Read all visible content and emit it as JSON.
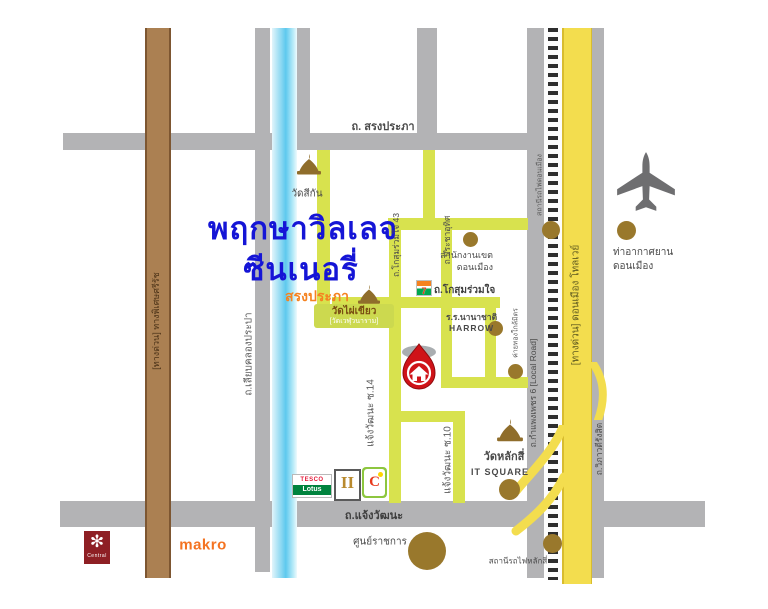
{
  "map": {
    "title_line1": "พฤกษาวิลเลจ",
    "title_line2": "ซีนเนอรี่",
    "title_subtitle": "สรงประภา",
    "roads": {
      "song_prapha": "ถ. สรงประภา",
      "chaengwattana": "ถ.แจ้งวัฒนะ",
      "srirat_expressway": "[ทางด่วน] ทางพิเศษศรีรัช",
      "liap_khlong_prapa": "ถ.เลียบคลองประปา",
      "kosum_ruam_chai_43": "ถ.โกสุมร่วมใจ 43",
      "pracha_uthit": "ถ.ประชาอุทิศ",
      "kosum_ruam_chai": "ถ.โกสุมร่วมใจ",
      "chaengwattana_soi_14": "แจ้งวัฒนะ ซ.14",
      "chaengwattana_soi_10": "แจ้งวัฒนะ ซ.10",
      "kamphaeng_phet_6": "ถ.กำแพงเพชร 6  [Local Road]",
      "don_mueang_tollway": "[ทางด่วน] ดอนเมือง โทลเวย์",
      "vibhavadi_rangsit": "ถ.วิภาวดีรังสิต"
    },
    "places": {
      "wat_sikan": "วัดสีกัน",
      "wat_phai_khiao": "วัดไผ่เขียว",
      "wat_phai_khiao_alt": "[วัดเวฬุวนาราม]",
      "district_office_line1": "สำนักงานเขต",
      "district_office_line2": "ดอนเมือง",
      "don_mueang_station": "สถานีรถไฟดอนเมือง",
      "airport_line1": "ท่าอากาศยาน",
      "airport_line2": "ดอนเมือง",
      "harrow_line1": "ร.ร.นานาชาติ",
      "harrow_line2": "HARROW",
      "khai_thong_klai_mit": "ค่ายทองใกล้มิตร",
      "wat_lak_si": "วัดหลักสี่",
      "it_square": "IT SQUARE",
      "government_center": "ศูนย์ราชการ",
      "lak_si_station": "สถานีรถไฟหลักสี่"
    },
    "brands": {
      "seven_eleven": "7",
      "tesco_line1": "TESCO",
      "tesco_line2": "Lotus",
      "pillars": "II",
      "big_c": "C",
      "central_glyph": "✻",
      "central": "Central",
      "makro": "makro"
    },
    "colors": {
      "road_gray": "#b3b3b5",
      "street_green": "#d8e24e",
      "tollway_yellow": "#f3dd4e",
      "expressway_brown": "#ab8052",
      "canal_blue": "#8fd9f2",
      "marker_red": "#cf1318",
      "poi_brown": "#99782c",
      "title_blue": "#1515d6",
      "subtitle_orange": "#f5821f"
    }
  }
}
